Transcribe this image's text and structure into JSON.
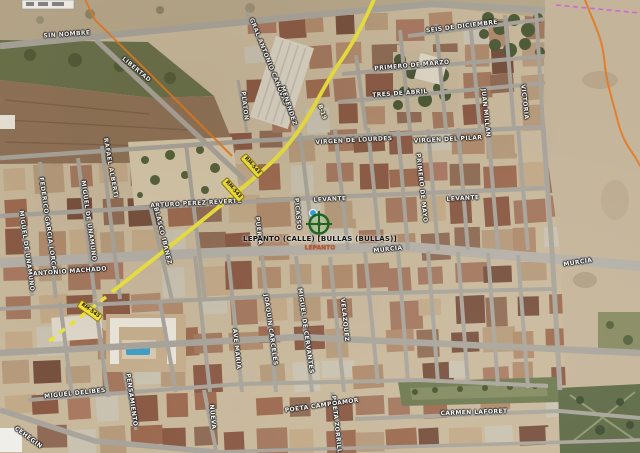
{
  "search_result": {
    "label": "LEPANTO (CALLE) [BULLAS (BULLAS)]",
    "sublabel": "LEPANTO"
  },
  "route": {
    "shield_text": "RM-543",
    "road_name": "B-19"
  },
  "route_label_pos": {
    "x": 322,
    "y": 112,
    "rot": 70
  },
  "shield_positions": [
    {
      "x": 252,
      "y": 166,
      "rot": 48
    },
    {
      "x": 233,
      "y": 190,
      "rot": 48
    },
    {
      "x": 90,
      "y": 311,
      "rot": 36
    }
  ],
  "marker": {
    "x": 319,
    "y": 224
  },
  "street_labels": [
    {
      "text": "SIN NOMBRE",
      "x": 67,
      "y": 35,
      "rot": -4
    },
    {
      "text": "LIBERTAD",
      "x": 136,
      "y": 70,
      "rot": 40
    },
    {
      "text": "GRAL ANTONIO CANOVAS",
      "x": 268,
      "y": 62,
      "rot": 68
    },
    {
      "text": "MENENDEZ",
      "x": 288,
      "y": 106,
      "rot": 72
    },
    {
      "text": "PLATON",
      "x": 244,
      "y": 106,
      "rot": 84
    },
    {
      "text": "SEIS DE DICIEMBRE",
      "x": 462,
      "y": 27,
      "rot": -7
    },
    {
      "text": "PRIMERO DE MARZO",
      "x": 412,
      "y": 66,
      "rot": -5
    },
    {
      "text": "TRES DE ABRIL",
      "x": 400,
      "y": 94,
      "rot": -4
    },
    {
      "text": "VIRGEN DE LOURDES",
      "x": 354,
      "y": 141,
      "rot": -3
    },
    {
      "text": "VIRGEN DEL PILAR",
      "x": 448,
      "y": 140,
      "rot": -3
    },
    {
      "text": "PRIMERO DE MAYO",
      "x": 421,
      "y": 188,
      "rot": 84
    },
    {
      "text": "JUAN MILLAN",
      "x": 485,
      "y": 113,
      "rot": 84
    },
    {
      "text": "VICTORIA",
      "x": 524,
      "y": 102,
      "rot": 84
    },
    {
      "text": "RAFAEL ALBERTI",
      "x": 110,
      "y": 168,
      "rot": 80
    },
    {
      "text": "ARTURO PEREZ REVERTE",
      "x": 196,
      "y": 204,
      "rot": -3
    },
    {
      "text": "FEDERICO GARCIA LORCA",
      "x": 47,
      "y": 224,
      "rot": 82
    },
    {
      "text": "MIGUEL DE UNAMUNO",
      "x": 26,
      "y": 251,
      "rot": 82
    },
    {
      "text": "MIGUEL DE UNAMUNO",
      "x": 88,
      "y": 221,
      "rot": 82
    },
    {
      "text": "BLASCO IBANEZ",
      "x": 162,
      "y": 236,
      "rot": 76
    },
    {
      "text": "ANTONIO MACHADO",
      "x": 70,
      "y": 272,
      "rot": -4
    },
    {
      "text": "PUERTA",
      "x": 258,
      "y": 231,
      "rot": 84
    },
    {
      "text": "PICASSO",
      "x": 297,
      "y": 214,
      "rot": 85
    },
    {
      "text": "LEVANTE",
      "x": 330,
      "y": 200,
      "rot": -3
    },
    {
      "text": "LEVANTE",
      "x": 463,
      "y": 199,
      "rot": -3
    },
    {
      "text": "MURCIA",
      "x": 388,
      "y": 250,
      "rot": -6
    },
    {
      "text": "MURCIA",
      "x": 578,
      "y": 263,
      "rot": -9
    },
    {
      "text": "AVE MARIA",
      "x": 236,
      "y": 349,
      "rot": 84
    },
    {
      "text": "JOAQUIN CARCELES",
      "x": 270,
      "y": 330,
      "rot": 82
    },
    {
      "text": "MIGUEL DE CERVANTES",
      "x": 305,
      "y": 331,
      "rot": 82
    },
    {
      "text": "VELAZQUEZ",
      "x": 344,
      "y": 320,
      "rot": 84
    },
    {
      "text": "NUEVA",
      "x": 212,
      "y": 417,
      "rot": 84
    },
    {
      "text": "PENSAMIENTO",
      "x": 131,
      "y": 400,
      "rot": 82
    },
    {
      "text": "MIGUEL DELIBES",
      "x": 75,
      "y": 394,
      "rot": -6
    },
    {
      "text": "POETA CAMPOAMOR",
      "x": 322,
      "y": 406,
      "rot": -8
    },
    {
      "text": "POETA ZORRILLA",
      "x": 336,
      "y": 427,
      "rot": 84
    },
    {
      "text": "CARMEN LAFORET",
      "x": 474,
      "y": 413,
      "rot": -2
    },
    {
      "text": "CEHEGIN",
      "x": 28,
      "y": 438,
      "rot": 36
    }
  ],
  "colors": {
    "route": "#ebe23e",
    "shield_bg": "#f2e23e",
    "municipal_boundary": "#e27a22",
    "admin_boundary": "#cf5fd8",
    "marker_green": "#17611f",
    "pin_blue": "#2da1e8"
  }
}
